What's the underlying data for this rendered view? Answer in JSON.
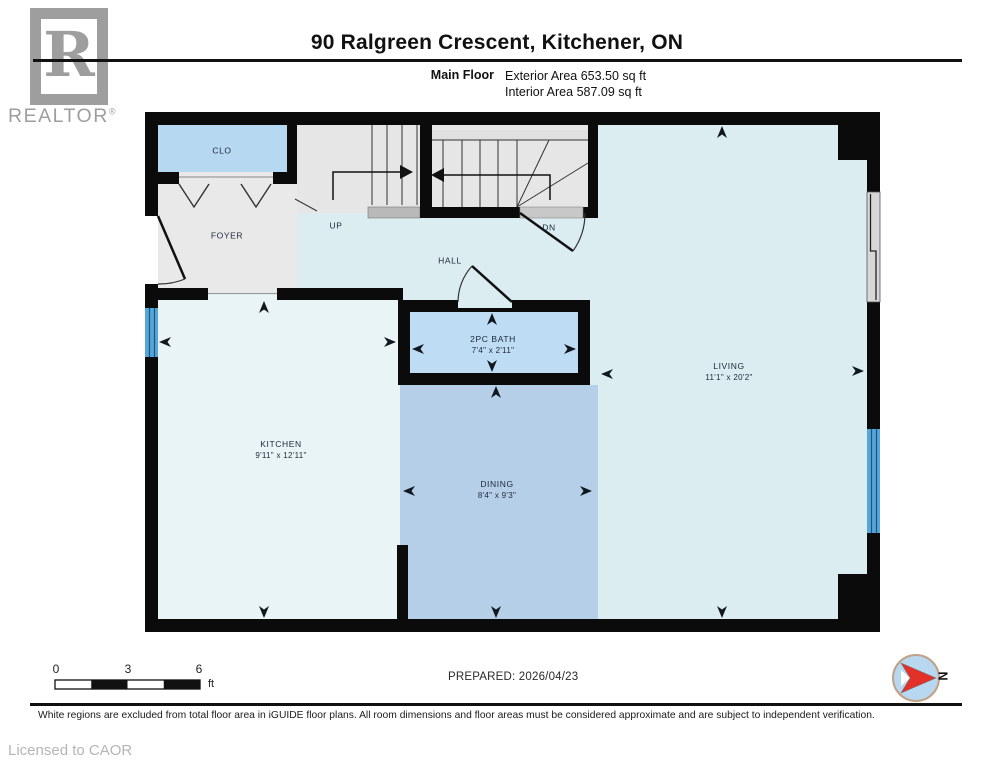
{
  "header": {
    "title": "90 Ralgreen Crescent, Kitchener, ON",
    "floor_label": "Main Floor",
    "exterior_area": "Exterior Area 653.50 sq ft",
    "interior_area": "Interior Area 587.09 sq ft",
    "logo": {
      "letter": "R",
      "brand": "REALTOR",
      "registered": "®"
    }
  },
  "rooms": {
    "clo": {
      "label": "CLO"
    },
    "foyer": {
      "label": "FOYER"
    },
    "stairs_up": {
      "label": "UP"
    },
    "stairs_dn": {
      "label": "DN"
    },
    "hall": {
      "label": "HALL"
    },
    "bath": {
      "label": "2PC BATH",
      "dims": "7'4\" x 2'11\""
    },
    "kitchen": {
      "label": "KITCHEN",
      "dims": "9'11\" x 12'11\""
    },
    "dining": {
      "label": "DINING",
      "dims": "8'4\" x 9'3\""
    },
    "living": {
      "label": "LIVING",
      "dims": "11'1\" x 20'2\""
    }
  },
  "scale": {
    "ticks": [
      "0",
      "3",
      "6"
    ],
    "unit": "ft"
  },
  "prepared": "PREPARED: 2026/04/23",
  "compass": {
    "label": "N"
  },
  "footer": {
    "disclaimer": "White regions are excluded from total floor area in iGUIDE floor plans. All room dimensions and floor areas must be considered approximate and are subject to independent verification.",
    "license": "Licensed to CAOR"
  },
  "colors": {
    "wall": "#0b0b0b",
    "closet_bath_blue": "#bedcf4",
    "dining_blue": "#b6cfe8",
    "living_hall_cyan": "#dcedf1",
    "kitchen_pale": "#e9f4f6",
    "foyer_gray": "#e9e9e9",
    "window_blue": "#57a6d9",
    "compass_red": "#e23128",
    "logo_gray": "#9e9e9e"
  }
}
